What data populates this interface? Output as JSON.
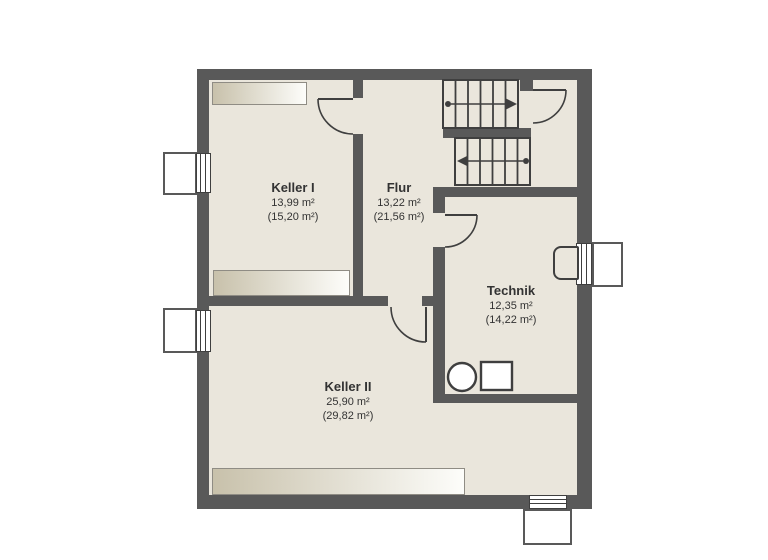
{
  "colors": {
    "wall": "#595959",
    "floor": "#eae6dc",
    "line": "#3f3f3f",
    "lightwell_fill": "#ffffff",
    "bar_start": "#c8c1ab",
    "bar_end": "#fdfdfa",
    "text": "#333333",
    "background": "#ffffff"
  },
  "rooms": [
    {
      "name": "Keller I",
      "area_net": "13,99 m²",
      "area_gross": "(15,20 m²)"
    },
    {
      "name": "Flur",
      "area_net": "13,22 m²",
      "area_gross": "(21,56 m²)"
    },
    {
      "name": "Technik",
      "area_net": "12,35 m²",
      "area_gross": "(14,22 m²)"
    },
    {
      "name": "Keller II",
      "area_net": "25,90 m²",
      "area_gross": "(29,82 m²)"
    }
  ]
}
